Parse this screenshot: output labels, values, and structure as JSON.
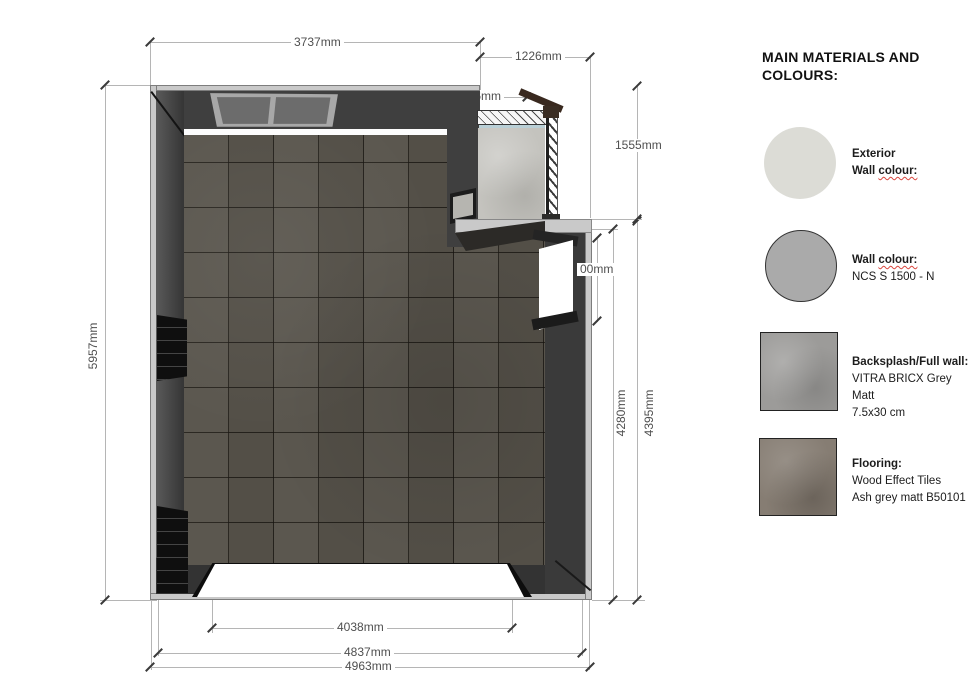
{
  "legend": {
    "title": "MAIN MATERIALS AND COLOURS:",
    "items": [
      {
        "id": "exterior-wall-colour",
        "swatch": "light-circle",
        "title": "Exterior",
        "sub_pre": "Wall ",
        "sub_squiggle": "colour:"
      },
      {
        "id": "wall-colour",
        "swatch": "grey-circle",
        "title_pre": "Wall ",
        "title_squiggle": "colour:",
        "sub": "NCS S 1500 - N"
      },
      {
        "id": "backsplash",
        "swatch": "concrete-square",
        "title": "Backsplash/Full wall:",
        "sub": "VITRA BRICX Grey Matt",
        "sub2": "7.5x30 cm"
      },
      {
        "id": "flooring",
        "swatch": "wood-square",
        "title": "Flooring:",
        "sub": "Wood Effect Tiles",
        "sub2": "Ash grey matt B50101"
      }
    ]
  },
  "dimensions": {
    "top_width": "3737mm",
    "balcony_width": "1226mm",
    "glass_roof_width": "896mm",
    "balcony_depth": "1555mm",
    "left_height": "5957mm",
    "right_window_height": "00mm",
    "interior_height": "4280mm",
    "interior_height_outer": "4395mm",
    "bottom_opening_width": "4038mm",
    "bottom_inner_width": "4837mm",
    "bottom_outer_width": "4963mm"
  },
  "colors": {
    "wall_dark": "#3f3f3f",
    "wall_outer_face": "#c9c9c9",
    "floor_tile": "#57534b",
    "concrete": "#c4c3be",
    "exterior_swatch": "#dcdcd6",
    "wall_swatch": "#aaaaaa",
    "backsplash_swatch": "#9c9b99",
    "flooring_swatch": "#867d73",
    "squiggle_red": "#d9453d",
    "dim_line": "#b5b5b5",
    "dim_text": "#4f4f4f"
  }
}
